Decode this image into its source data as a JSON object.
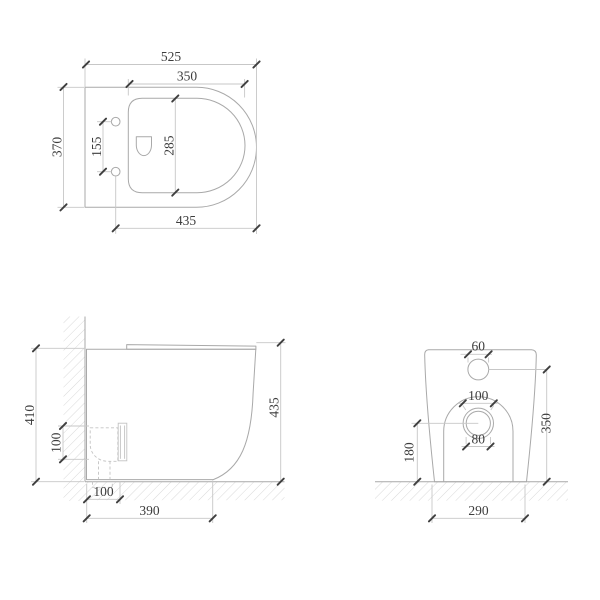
{
  "drawing": {
    "top_view": {
      "width_total": "525",
      "seat_width": "350",
      "depth_total": "370",
      "hole_spacing": "155",
      "bowl_length": "285",
      "seat_length": "435"
    },
    "side_view": {
      "height_total": "410",
      "trap_diameter": "100",
      "trap_offset": "100",
      "base_depth": "390",
      "front_height": "435"
    },
    "rear_view": {
      "inlet_width": "60",
      "outlet_outer_diameter": "100",
      "outlet_inner_diameter": "80",
      "outlet_height": "180",
      "inlet_height": "350",
      "base_width": "290"
    }
  },
  "colors": {
    "background": "#ffffff",
    "outline": "#a9a9a9",
    "dim_line": "#c7c7c7",
    "hatch": "#d9d9d9",
    "dashed": "#c3c3c3",
    "tick": "#3f3f3f",
    "text": "#3d3d3d"
  }
}
